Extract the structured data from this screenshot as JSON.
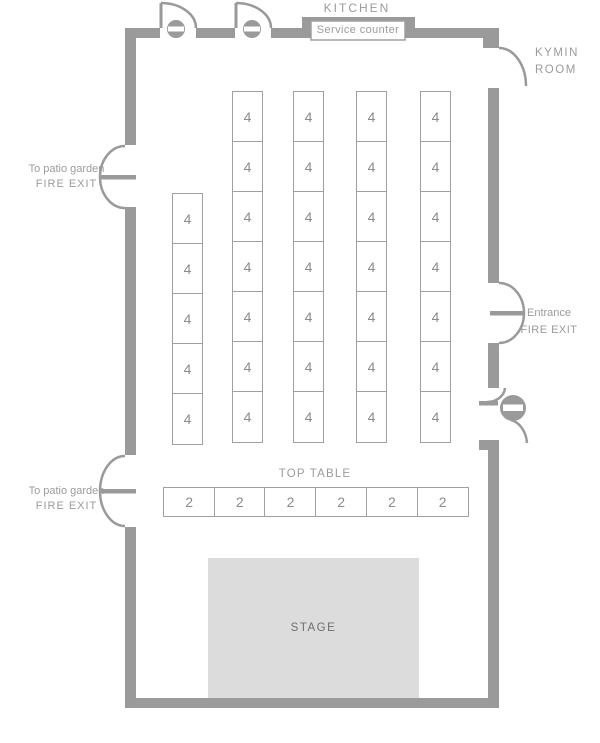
{
  "room": {
    "kitchen_label": "KITCHEN",
    "service_counter_label": "Service counter",
    "name_line1": "KYMIN",
    "name_line2": "ROOM",
    "top_table_label": "TOP TABLE",
    "stage_label": "STAGE"
  },
  "exits": {
    "patio": {
      "line1": "To patio garden",
      "line2": "FIRE EXIT"
    },
    "entrance": {
      "line1": "Entrance",
      "line2": "FIRE EXIT"
    }
  },
  "tables": {
    "four_seat": {
      "seats_label": "4",
      "cell_width": 31,
      "cell_height": 50,
      "columns": [
        {
          "x": 172,
          "y": 193,
          "count": 5
        },
        {
          "x": 232,
          "y": 91,
          "count": 7
        },
        {
          "x": 293,
          "y": 91,
          "count": 7
        },
        {
          "x": 356,
          "y": 91,
          "count": 7
        },
        {
          "x": 420,
          "y": 91,
          "count": 7
        }
      ]
    },
    "top_table": {
      "seats_label": "2",
      "count": 6,
      "x": 163,
      "y": 487,
      "cell_width": 50.7,
      "cell_height": 30
    }
  },
  "colors": {
    "wall": "#9a9a9a",
    "table_border": "#a0a0a0",
    "label_text": "#9b9b9b",
    "number_text": "#8b8b8b",
    "stage_fill": "#dcdcdc",
    "stage_text": "#6e6e6e"
  }
}
